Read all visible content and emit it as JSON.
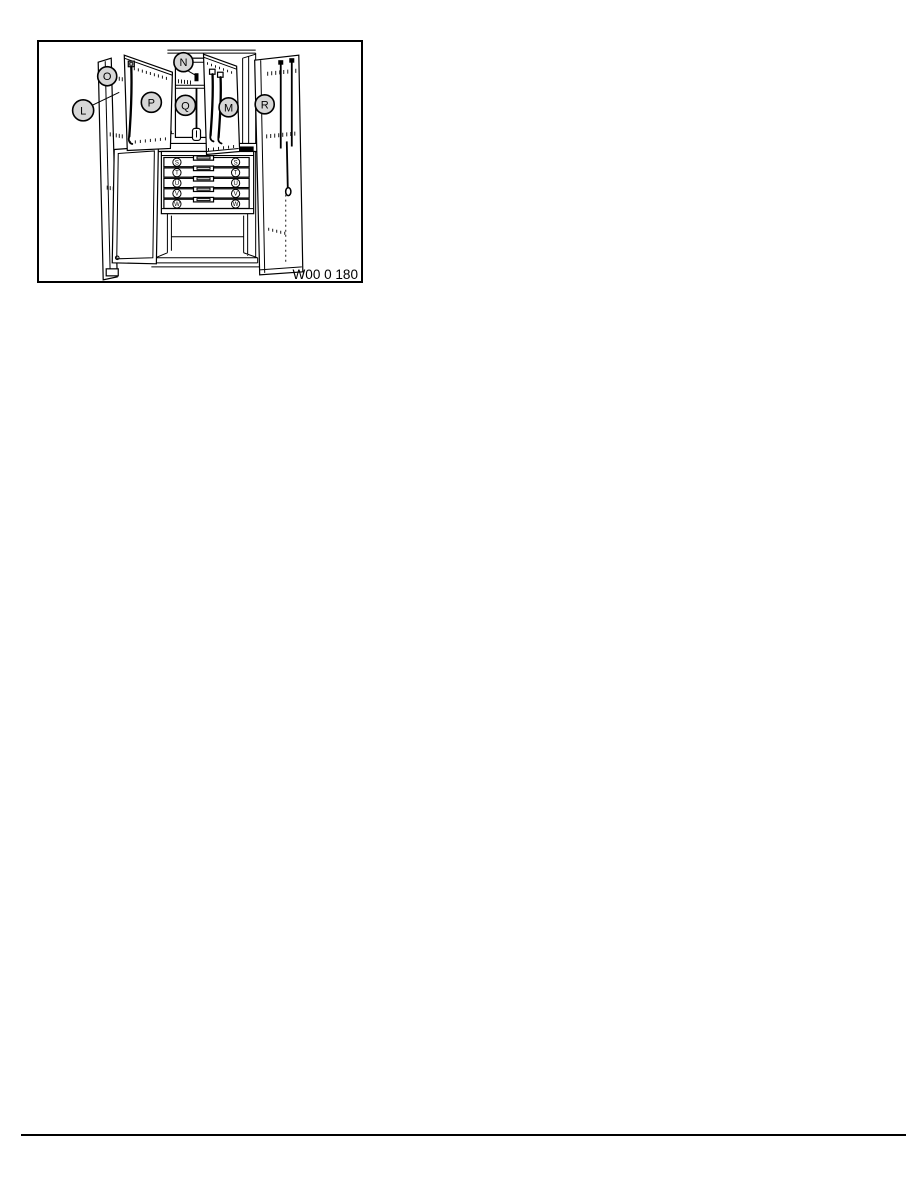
{
  "page": {
    "background_color": "#ffffff",
    "line_color": "#000000"
  },
  "figure": {
    "number": "W00 0 180",
    "description": "Line drawing of a workshop special-tools cabinet with outer and inner doors open and a five-drawer chest",
    "colors": {
      "callout_fill": "#d7d7d7",
      "line": "#000000"
    },
    "callouts": [
      {
        "letter": "L"
      },
      {
        "letter": "O"
      },
      {
        "letter": "N"
      },
      {
        "letter": "P"
      },
      {
        "letter": "Q"
      },
      {
        "letter": "M"
      },
      {
        "letter": "R"
      }
    ],
    "drawers": [
      {
        "letter": "S"
      },
      {
        "letter": "T"
      },
      {
        "letter": "U"
      },
      {
        "letter": "V"
      },
      {
        "letter": "W"
      }
    ]
  }
}
